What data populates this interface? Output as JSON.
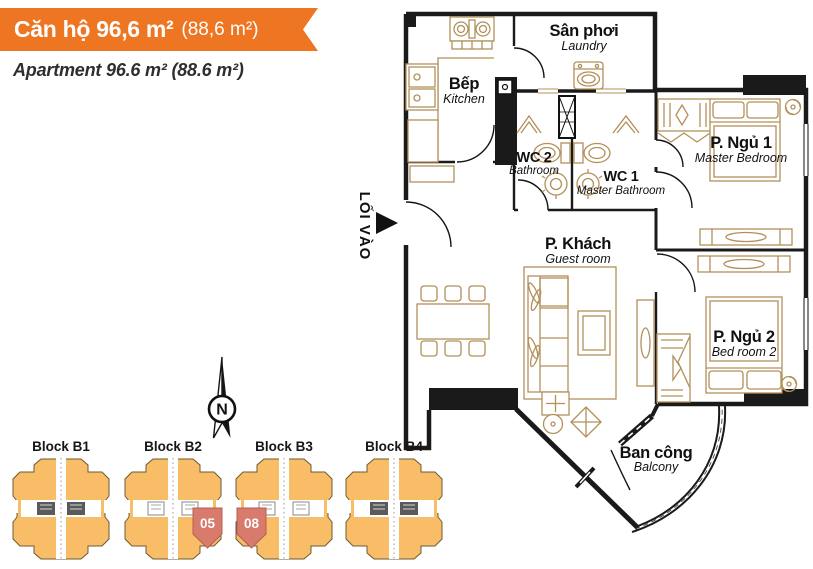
{
  "header": {
    "title_main": "Căn hộ 96,6 m²",
    "title_paren": "(88,6 m²)",
    "subtitle": "Apartment 96.6 m² (88.6 m²)",
    "banner_color": "#ee7623"
  },
  "floorplan": {
    "entrance_label": "LỐI VÀO",
    "rooms": {
      "laundry": {
        "vi": "Sân phơi",
        "en": "Laundry"
      },
      "kitchen": {
        "vi": "Bếp",
        "en": "Kitchen"
      },
      "wc2": {
        "vi": "WC 2",
        "en": "Bathroom"
      },
      "wc1": {
        "vi": "WC 1",
        "en": "Master Bathroom"
      },
      "master_bedroom": {
        "vi": "P. Ngủ 1",
        "en": "Master Bedroom"
      },
      "living": {
        "vi": "P. Khách",
        "en": "Guest room"
      },
      "bedroom2": {
        "vi": "P. Ngủ 2",
        "en": "Bed room 2"
      },
      "balcony": {
        "vi": "Ban công",
        "en": "Balcony"
      }
    },
    "colors": {
      "wall": "#1a1a1a",
      "furniture": "#b2905a"
    }
  },
  "site_map": {
    "compass_label": "N",
    "blocks": [
      {
        "label": "Block B1"
      },
      {
        "label": "Block B2",
        "highlight_unit": "05"
      },
      {
        "label": "Block B3",
        "highlight_unit": "08"
      },
      {
        "label": "Block B4"
      }
    ],
    "colors": {
      "block_fill": "#f8bd66",
      "unit_fill": "#d97b6c"
    }
  }
}
